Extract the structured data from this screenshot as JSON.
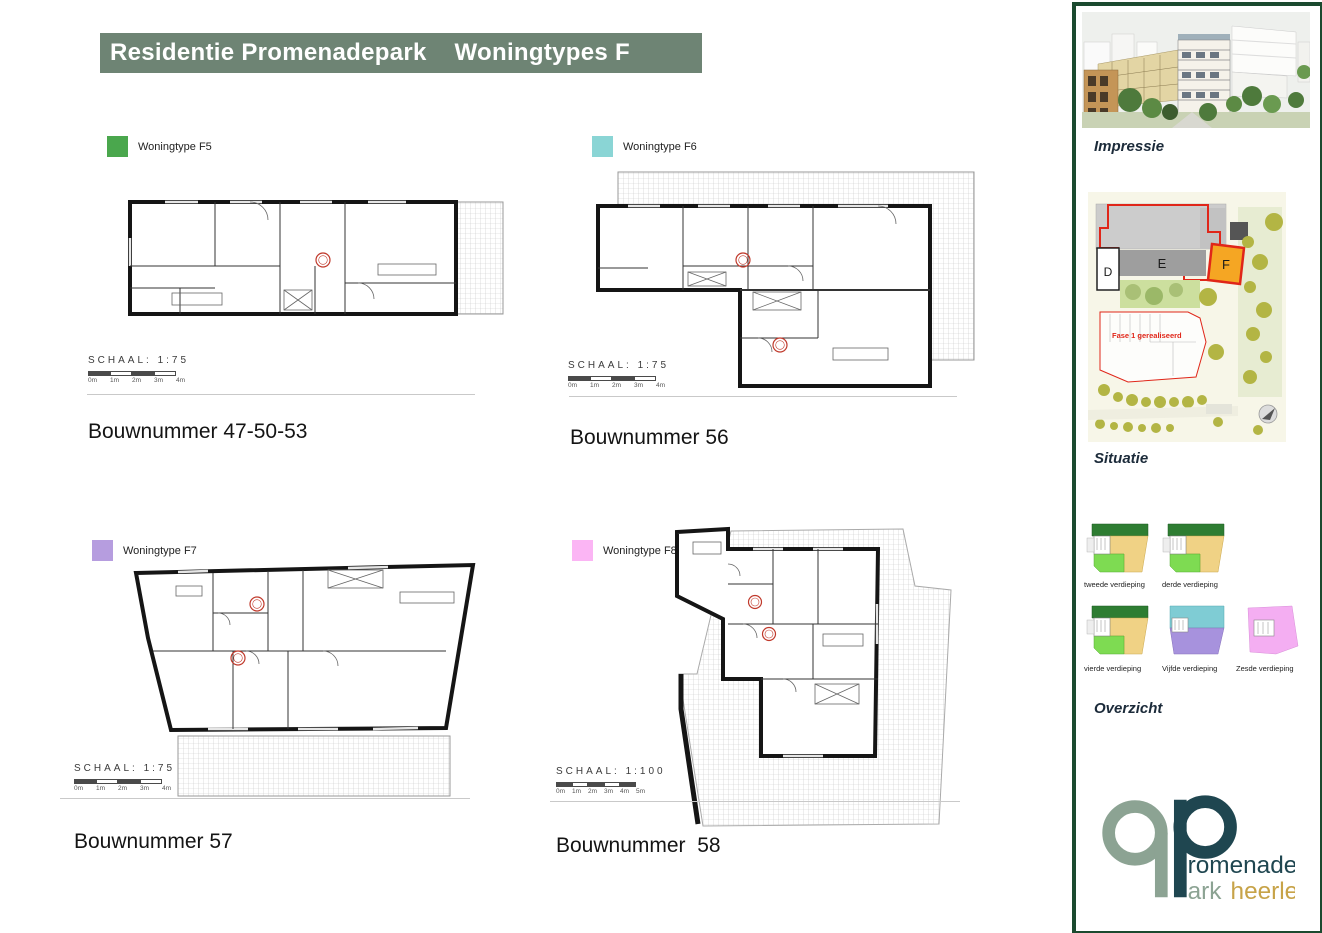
{
  "page": {
    "title_bar": "Residentie Promenadepark    Woningtypes F"
  },
  "colors": {
    "title_bar_bg": "#6e8474",
    "sidebar_border": "#1b4a2f",
    "situatie_f_highlight": "#f5a623",
    "phase_note_red": "#e02619",
    "logo_teal": "#1f4650",
    "logo_sage": "#8ca393",
    "logo_gold": "#c7a348"
  },
  "plans": [
    {
      "legend": "Woningtype F5",
      "swatch": "#4aa74d",
      "schaal": "SCHAAL: 1:75",
      "ticks": [
        "0m",
        "1m",
        "2m",
        "3m",
        "4m"
      ],
      "bouwnummer": "Bouwnummer 47-50-53"
    },
    {
      "legend": "Woningtype F6",
      "swatch": "#8ad5d5",
      "schaal": "SCHAAL: 1:75",
      "ticks": [
        "0m",
        "1m",
        "2m",
        "3m",
        "4m"
      ],
      "bouwnummer": "Bouwnummer 56"
    },
    {
      "legend": "Woningtype F7",
      "swatch": "#b69ddf",
      "schaal": "SCHAAL: 1:75",
      "ticks": [
        "0m",
        "1m",
        "2m",
        "3m",
        "4m"
      ],
      "bouwnummer": "Bouwnummer 57"
    },
    {
      "legend": "Woningtype F8",
      "swatch": "#fbb5f4",
      "schaal": "SCHAAL: 1:100",
      "ticks": [
        "0m",
        "1m",
        "2m",
        "3m",
        "4m",
        "5m"
      ],
      "bouwnummer": "Bouwnummer  58"
    }
  ],
  "sidebar": {
    "impressie_label": "Impressie",
    "situatie_label": "Situatie",
    "overzicht_label": "Overzicht",
    "situatie": {
      "building_d": "D",
      "building_e": "E",
      "building_f": "F",
      "phase_note": "Fase 1 gerealiseerd"
    },
    "floors": [
      {
        "label": "tweede verdieping"
      },
      {
        "label": "derde verdieping"
      },
      {
        "label": "vierde verdieping"
      },
      {
        "label": "Vijfde verdieping"
      },
      {
        "label": "Zesde verdieping"
      }
    ],
    "logo": {
      "p1": "romenade",
      "p2": "ark",
      "p3": "heerlen"
    }
  }
}
